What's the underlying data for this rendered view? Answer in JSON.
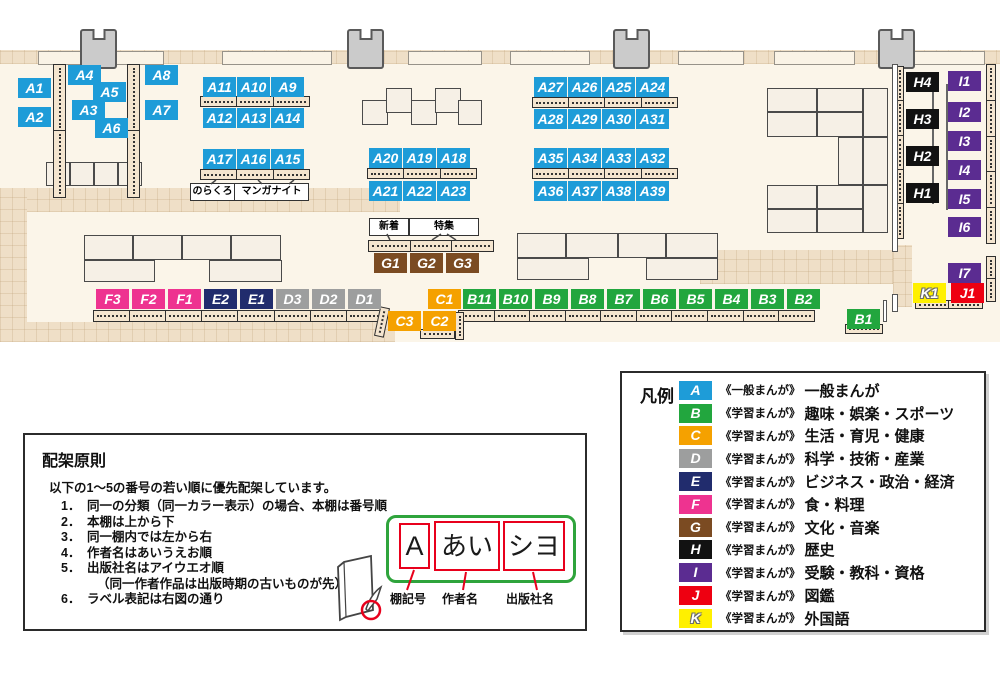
{
  "map": {
    "floor_color": "#FBF5E9",
    "corridor_color": "#EFDFC7",
    "category_colors": {
      "A": "#1E9CD8",
      "B": "#22A63E",
      "C": "#F5A100",
      "D": "#9D9E9E",
      "E": "#212C6D",
      "F": "#EE3390",
      "G": "#7B4B22",
      "H": "#121212",
      "I": "#5B2C91",
      "J": "#EE0011",
      "K": "#FFF000"
    },
    "pillars": [
      80,
      347,
      613,
      878
    ],
    "windows": [
      [
        38,
        124
      ],
      [
        222,
        108
      ],
      [
        408,
        72
      ],
      [
        510,
        78
      ],
      [
        678,
        64
      ],
      [
        774,
        79
      ],
      [
        913,
        70
      ]
    ],
    "shelves": [
      {
        "x": 53,
        "y": 64,
        "w": 13,
        "h": 134,
        "n": 2,
        "v": 1
      },
      {
        "x": 127,
        "y": 64,
        "w": 13,
        "h": 134,
        "n": 2,
        "v": 1
      },
      {
        "x": 200,
        "y": 96,
        "w": 110,
        "h": 11,
        "n": 3
      },
      {
        "x": 200,
        "y": 169,
        "w": 110,
        "h": 11,
        "n": 3
      },
      {
        "x": 367,
        "y": 168,
        "w": 110,
        "h": 11,
        "n": 3
      },
      {
        "x": 532,
        "y": 97,
        "w": 146,
        "h": 11,
        "n": 4
      },
      {
        "x": 532,
        "y": 168,
        "w": 146,
        "h": 11,
        "n": 4
      },
      {
        "x": 368,
        "y": 240,
        "w": 126,
        "h": 12,
        "n": 3
      },
      {
        "x": 93,
        "y": 310,
        "w": 290,
        "h": 12,
        "n": 8
      },
      {
        "x": 458,
        "y": 310,
        "w": 357,
        "h": 12,
        "n": 10
      },
      {
        "x": 845,
        "y": 324,
        "w": 38,
        "h": 10,
        "n": 1
      },
      {
        "x": 915,
        "y": 300,
        "w": 68,
        "h": 9,
        "n": 2
      },
      {
        "x": 420,
        "y": 329,
        "w": 35,
        "h": 10,
        "n": 1
      },
      {
        "x": 377,
        "y": 307,
        "w": 10,
        "h": 30,
        "n": 1,
        "v": 1,
        "rot": 12
      },
      {
        "x": 455,
        "y": 312,
        "w": 9,
        "h": 28,
        "n": 1,
        "v": 1
      },
      {
        "x": 895,
        "y": 66,
        "w": 9,
        "h": 173,
        "n": 5,
        "v": 1
      },
      {
        "x": 986,
        "y": 64,
        "w": 10,
        "h": 180,
        "n": 5,
        "v": 1
      },
      {
        "x": 986,
        "y": 256,
        "w": 10,
        "h": 46,
        "n": 2,
        "v": 1
      }
    ],
    "tables": [
      [
        46,
        162,
        24,
        24
      ],
      [
        70,
        162,
        24,
        24
      ],
      [
        94,
        162,
        24,
        24
      ],
      [
        118,
        162,
        24,
        24
      ],
      [
        84,
        235,
        49,
        25
      ],
      [
        133,
        235,
        49,
        25
      ],
      [
        182,
        235,
        49,
        25
      ],
      [
        231,
        235,
        50,
        25
      ],
      [
        84,
        260,
        71,
        22
      ],
      [
        209,
        260,
        73,
        22
      ],
      [
        362,
        100,
        26,
        25
      ],
      [
        386,
        88,
        26,
        25
      ],
      [
        411,
        100,
        26,
        25
      ],
      [
        435,
        88,
        26,
        25
      ],
      [
        458,
        100,
        24,
        25
      ],
      [
        517,
        233,
        49,
        25
      ],
      [
        566,
        233,
        52,
        25
      ],
      [
        618,
        233,
        48,
        25
      ],
      [
        666,
        233,
        52,
        25
      ],
      [
        517,
        258,
        72,
        22
      ],
      [
        646,
        258,
        72,
        22
      ],
      [
        767,
        88,
        50,
        24
      ],
      [
        817,
        88,
        46,
        24
      ],
      [
        863,
        88,
        25,
        49
      ],
      [
        767,
        112,
        50,
        25
      ],
      [
        817,
        112,
        46,
        25
      ],
      [
        838,
        137,
        25,
        48
      ],
      [
        863,
        137,
        25,
        48
      ],
      [
        767,
        185,
        50,
        24
      ],
      [
        817,
        185,
        46,
        24
      ],
      [
        863,
        185,
        25,
        48
      ],
      [
        767,
        209,
        50,
        24
      ],
      [
        817,
        209,
        46,
        24
      ]
    ],
    "labels": [
      {
        "t": "A1",
        "c": "A",
        "x": 18,
        "y": 78
      },
      {
        "t": "A2",
        "c": "A",
        "x": 18,
        "y": 107
      },
      {
        "t": "A4",
        "c": "A",
        "x": 68,
        "y": 65
      },
      {
        "t": "A5",
        "c": "A",
        "x": 93,
        "y": 82
      },
      {
        "t": "A3",
        "c": "A",
        "x": 72,
        "y": 100
      },
      {
        "t": "A6",
        "c": "A",
        "x": 95,
        "y": 118
      },
      {
        "t": "A8",
        "c": "A",
        "x": 145,
        "y": 65
      },
      {
        "t": "A7",
        "c": "A",
        "x": 145,
        "y": 100
      },
      {
        "t": "A11",
        "c": "A",
        "x": 203,
        "y": 77
      },
      {
        "t": "A10",
        "c": "A",
        "x": 237,
        "y": 77
      },
      {
        "t": "A9",
        "c": "A",
        "x": 271,
        "y": 77
      },
      {
        "t": "A12",
        "c": "A",
        "x": 203,
        "y": 108
      },
      {
        "t": "A13",
        "c": "A",
        "x": 237,
        "y": 108
      },
      {
        "t": "A14",
        "c": "A",
        "x": 271,
        "y": 108
      },
      {
        "t": "A17",
        "c": "A",
        "x": 203,
        "y": 149
      },
      {
        "t": "A16",
        "c": "A",
        "x": 237,
        "y": 149
      },
      {
        "t": "A15",
        "c": "A",
        "x": 271,
        "y": 149
      },
      {
        "t": "A20",
        "c": "A",
        "x": 369,
        "y": 148
      },
      {
        "t": "A19",
        "c": "A",
        "x": 403,
        "y": 148
      },
      {
        "t": "A18",
        "c": "A",
        "x": 437,
        "y": 148
      },
      {
        "t": "A21",
        "c": "A",
        "x": 369,
        "y": 181
      },
      {
        "t": "A22",
        "c": "A",
        "x": 403,
        "y": 181
      },
      {
        "t": "A23",
        "c": "A",
        "x": 437,
        "y": 181
      },
      {
        "t": "A27",
        "c": "A",
        "x": 534,
        "y": 77
      },
      {
        "t": "A26",
        "c": "A",
        "x": 568,
        "y": 77
      },
      {
        "t": "A25",
        "c": "A",
        "x": 602,
        "y": 77
      },
      {
        "t": "A24",
        "c": "A",
        "x": 636,
        "y": 77
      },
      {
        "t": "A28",
        "c": "A",
        "x": 534,
        "y": 109
      },
      {
        "t": "A29",
        "c": "A",
        "x": 568,
        "y": 109
      },
      {
        "t": "A30",
        "c": "A",
        "x": 602,
        "y": 109
      },
      {
        "t": "A31",
        "c": "A",
        "x": 636,
        "y": 109
      },
      {
        "t": "A35",
        "c": "A",
        "x": 534,
        "y": 148
      },
      {
        "t": "A34",
        "c": "A",
        "x": 568,
        "y": 148
      },
      {
        "t": "A33",
        "c": "A",
        "x": 602,
        "y": 148
      },
      {
        "t": "A32",
        "c": "A",
        "x": 636,
        "y": 148
      },
      {
        "t": "A36",
        "c": "A",
        "x": 534,
        "y": 181
      },
      {
        "t": "A37",
        "c": "A",
        "x": 568,
        "y": 181
      },
      {
        "t": "A38",
        "c": "A",
        "x": 602,
        "y": 181
      },
      {
        "t": "A39",
        "c": "A",
        "x": 636,
        "y": 181
      },
      {
        "t": "G1",
        "c": "G",
        "x": 374,
        "y": 253
      },
      {
        "t": "G2",
        "c": "G",
        "x": 410,
        "y": 253
      },
      {
        "t": "G3",
        "c": "G",
        "x": 446,
        "y": 253
      },
      {
        "t": "F3",
        "c": "F",
        "x": 96,
        "y": 289
      },
      {
        "t": "F2",
        "c": "F",
        "x": 132,
        "y": 289
      },
      {
        "t": "F1",
        "c": "F",
        "x": 168,
        "y": 289
      },
      {
        "t": "E2",
        "c": "E",
        "x": 204,
        "y": 289
      },
      {
        "t": "E1",
        "c": "E",
        "x": 240,
        "y": 289
      },
      {
        "t": "D3",
        "c": "D",
        "x": 276,
        "y": 289
      },
      {
        "t": "D2",
        "c": "D",
        "x": 312,
        "y": 289
      },
      {
        "t": "D1",
        "c": "D",
        "x": 348,
        "y": 289
      },
      {
        "t": "C1",
        "c": "C",
        "x": 428,
        "y": 289
      },
      {
        "t": "B11",
        "c": "B",
        "x": 463,
        "y": 289
      },
      {
        "t": "B10",
        "c": "B",
        "x": 499,
        "y": 289
      },
      {
        "t": "B9",
        "c": "B",
        "x": 535,
        "y": 289
      },
      {
        "t": "B8",
        "c": "B",
        "x": 571,
        "y": 289
      },
      {
        "t": "B7",
        "c": "B",
        "x": 607,
        "y": 289
      },
      {
        "t": "B6",
        "c": "B",
        "x": 643,
        "y": 289
      },
      {
        "t": "B5",
        "c": "B",
        "x": 679,
        "y": 289
      },
      {
        "t": "B4",
        "c": "B",
        "x": 715,
        "y": 289
      },
      {
        "t": "B3",
        "c": "B",
        "x": 751,
        "y": 289
      },
      {
        "t": "B2",
        "c": "B",
        "x": 787,
        "y": 289
      },
      {
        "t": "C3",
        "c": "C",
        "x": 388,
        "y": 311
      },
      {
        "t": "C2",
        "c": "C",
        "x": 423,
        "y": 311
      },
      {
        "t": "B1",
        "c": "B",
        "x": 847,
        "y": 309
      },
      {
        "t": "H4",
        "c": "H",
        "x": 906,
        "y": 72
      },
      {
        "t": "H3",
        "c": "H",
        "x": 906,
        "y": 109
      },
      {
        "t": "H2",
        "c": "H",
        "x": 906,
        "y": 146
      },
      {
        "t": "H1",
        "c": "H",
        "x": 906,
        "y": 183
      },
      {
        "t": "I1",
        "c": "I",
        "x": 948,
        "y": 71
      },
      {
        "t": "I2",
        "c": "I",
        "x": 948,
        "y": 102
      },
      {
        "t": "I3",
        "c": "I",
        "x": 948,
        "y": 131
      },
      {
        "t": "I4",
        "c": "I",
        "x": 948,
        "y": 160
      },
      {
        "t": "I5",
        "c": "I",
        "x": 948,
        "y": 189
      },
      {
        "t": "I6",
        "c": "I",
        "x": 948,
        "y": 217
      },
      {
        "t": "I7",
        "c": "I",
        "x": 948,
        "y": 263
      },
      {
        "t": "K1",
        "c": "K",
        "x": 913,
        "y": 283
      },
      {
        "t": "J1",
        "c": "J",
        "x": 951,
        "y": 283
      }
    ],
    "tags": [
      {
        "t": "のらくろ",
        "x": 190,
        "y": 183,
        "w": 43
      },
      {
        "t": "マンガナイト",
        "x": 234,
        "y": 183,
        "w": 73
      },
      {
        "t": "新着",
        "x": 369,
        "y": 218,
        "w": 38
      },
      {
        "t": "特集",
        "x": 409,
        "y": 218,
        "w": 68
      }
    ],
    "lines": [
      [
        932,
        82,
        2,
        122
      ],
      [
        946,
        84,
        2,
        126
      ]
    ],
    "walls": [
      [
        892,
        64,
        6,
        188
      ],
      [
        892,
        294,
        6,
        18
      ],
      [
        883,
        300,
        4,
        22
      ]
    ]
  },
  "legend": {
    "title": "凡例",
    "items": [
      {
        "code": "A",
        "type": "《一般まんが》",
        "label": "一般まんが"
      },
      {
        "code": "B",
        "type": "《学習まんが》",
        "label": "趣味・娯楽・スポーツ"
      },
      {
        "code": "C",
        "type": "《学習まんが》",
        "label": "生活・育児・健康"
      },
      {
        "code": "D",
        "type": "《学習まんが》",
        "label": "科学・技術・産業"
      },
      {
        "code": "E",
        "type": "《学習まんが》",
        "label": "ビジネス・政治・経済"
      },
      {
        "code": "F",
        "type": "《学習まんが》",
        "label": "食・料理"
      },
      {
        "code": "G",
        "type": "《学習まんが》",
        "label": "文化・音楽"
      },
      {
        "code": "H",
        "type": "《学習まんが》",
        "label": "歴史"
      },
      {
        "code": "I",
        "type": "《学習まんが》",
        "label": "受験・教科・資格"
      },
      {
        "code": "J",
        "type": "《学習まんが》",
        "label": "図鑑"
      },
      {
        "code": "K",
        "type": "《学習まんが》",
        "label": "外国語"
      }
    ]
  },
  "principles": {
    "title": "配架原則",
    "intro": "以下の1〜5の番号の若い順に優先配架しています。",
    "items": [
      {
        "n": "1．",
        "t": "同一の分類（同一カラー表示）の場合、本棚は番号順"
      },
      {
        "n": "2．",
        "t": "本棚は上から下"
      },
      {
        "n": "3．",
        "t": "同一棚内では左から右"
      },
      {
        "n": "4．",
        "t": "作者名はあいうえお順"
      },
      {
        "n": "5．",
        "t": "出版社名はアイウエオ順"
      },
      {
        "n": "",
        "t": "（同一作者作品は出版時期の古いものが先）",
        "cont": true
      },
      {
        "n": "6．",
        "t": "ラベル表記は右図の通り"
      }
    ],
    "label_diagram": {
      "boxes": [
        "A",
        "あい",
        "シヨ"
      ],
      "captions": [
        "棚記号",
        "作者名",
        "出版社名"
      ]
    }
  }
}
